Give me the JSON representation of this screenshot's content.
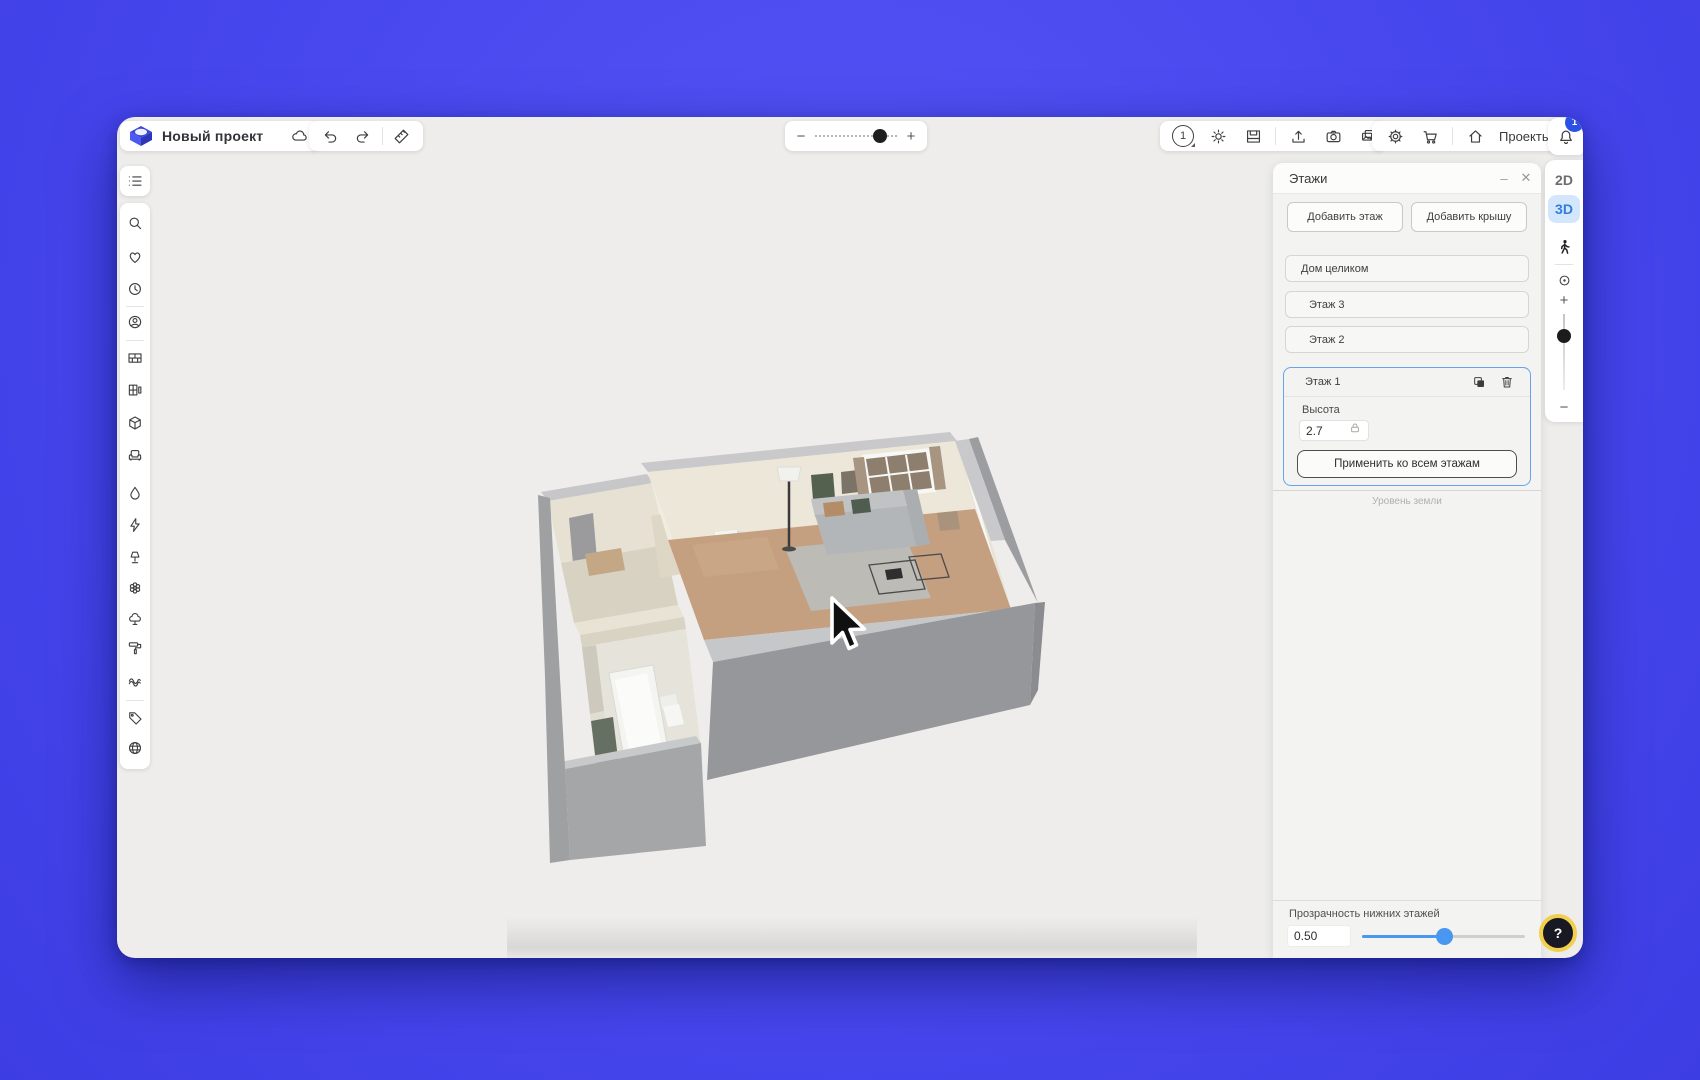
{
  "topbar": {
    "project_title": "Новый проект",
    "floor_indicator": "1",
    "projects_label": "Проекты",
    "notification_count": "1",
    "zoom_minus": "−",
    "zoom_plus": "+",
    "zoom_position_percent": 77,
    "icons": [
      "logo",
      "cloud-sync",
      "undo",
      "redo",
      "ruler",
      "floor-number",
      "sun-brightness",
      "snapshot-frame",
      "export-upload",
      "camera",
      "gallery",
      "settings-gear",
      "shopping-cart",
      "home-projects",
      "notification-bell"
    ]
  },
  "sidebar": {
    "icons": [
      "objects-list",
      "search",
      "favorites-heart",
      "history-clock",
      "user-profile",
      "walls-bricks",
      "windows-doors",
      "construction-cube",
      "furniture-armchair",
      "plumbing-droplet",
      "electric-bolt",
      "lighting-lamp",
      "decor-flower",
      "garden-tree",
      "paint-roller",
      "textile-rug",
      "price-tag",
      "region-globe"
    ]
  },
  "floors_panel": {
    "title": "Этажи",
    "window_controls": {
      "minimize": "–",
      "close": "✕"
    },
    "add_floor_label": "Добавить этаж",
    "add_roof_label": "Добавить крышу",
    "whole_house_label": "Дом целиком",
    "floors": [
      {
        "label": "Этаж 3"
      },
      {
        "label": "Этаж 2"
      }
    ],
    "selected_floor": {
      "label": "Этаж 1",
      "height_label": "Высота",
      "height_value": "2.7",
      "apply_all_label": "Применить ко всем этажам",
      "icons": [
        "duplicate-floor",
        "delete-floor",
        "height-lock"
      ]
    },
    "ground_level_label": "Уровень земли",
    "transparency": {
      "label": "Прозрачность нижних этажей",
      "value": "0.50",
      "percent": 50
    }
  },
  "view_controls": {
    "mode_2d": "2D",
    "mode_3d": "3D",
    "active_mode": "3D",
    "zoom_plus": "+",
    "zoom_minus": "−",
    "zoom_position_percent": 30,
    "icons": [
      "walk-view",
      "orbit-target"
    ]
  },
  "help_button": {
    "label": "?"
  },
  "colors": {
    "background_blue": "#4747ee",
    "accent_blue": "#3e8ef0",
    "selection_border": "#66a5e9",
    "badge_blue": "#2b50e8",
    "help_ring_yellow": "#f0d04c",
    "mode_3d_text": "#2f7de1"
  }
}
